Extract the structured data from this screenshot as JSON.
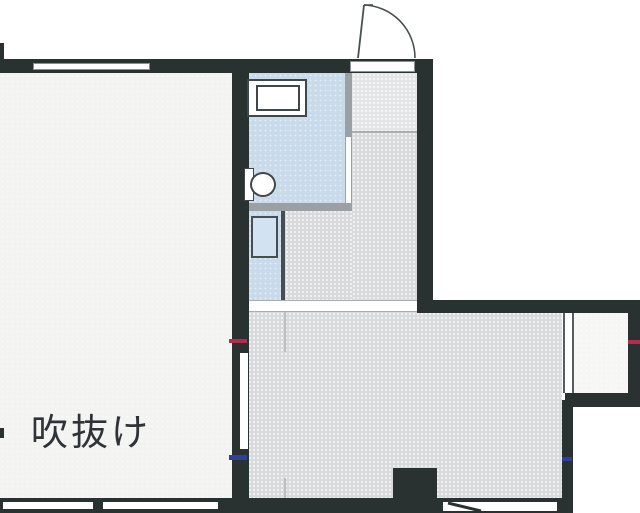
{
  "plan": {
    "labels": {
      "void_room": "吹抜け"
    },
    "icons": {
      "entry_door": "door-swing-arc",
      "toilet": "toilet-icon",
      "sink": "sink-counter-icon",
      "washer_pan": "washer-pan-icon"
    },
    "colors": {
      "wall": "#2a3231",
      "floor_gray": "#d8dadd",
      "entry_gray": "#e3e5e7",
      "room_light": "#f3f3f1",
      "water_blue": "#c9dbeb",
      "pan_blue": "#d3e2f0",
      "partition_gray": "#9aa0a3",
      "outline": "#40474a",
      "mark_red": "#b72a50",
      "mark_blue": "#2e3f9d",
      "balcony": "#f6f7f5"
    }
  }
}
